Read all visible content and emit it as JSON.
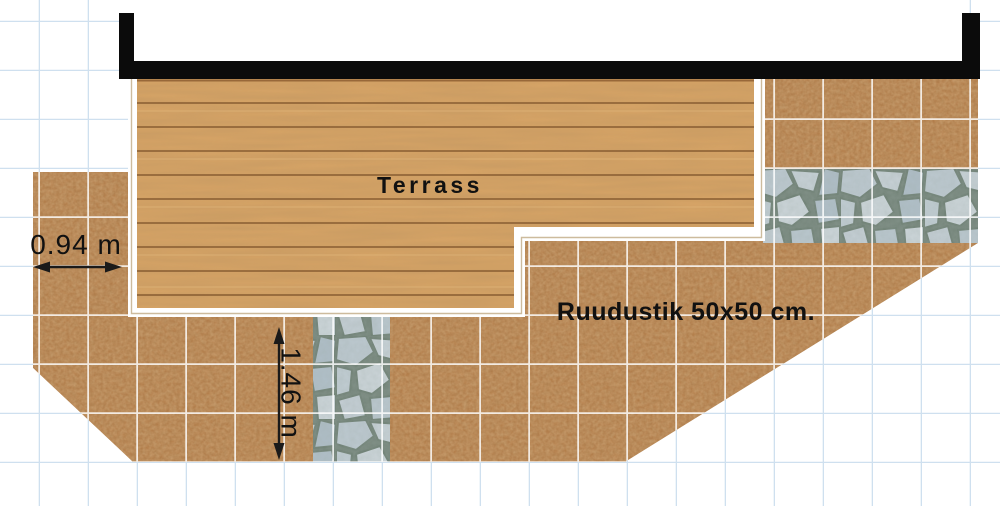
{
  "figure": {
    "type": "garden-terrace-plan",
    "labels": {
      "terrace": "Terrass",
      "grid_note": "Ruudustik 50x50 cm."
    },
    "dimensions": {
      "left_soil_strip_width": "0.94 m",
      "lower_soil_strip_height": "1.46 m"
    },
    "colors": {
      "wall": "#0b0b0b",
      "wood": "#d7a466",
      "soil": "#ad7440",
      "stone": "#b5c2ca",
      "stone_joint": "#75857a",
      "paper_grid_line": "#cfe0ef",
      "plan_grid_line": "#ffffff",
      "terrace_border": "#ffffff",
      "text": "#111111"
    }
  }
}
